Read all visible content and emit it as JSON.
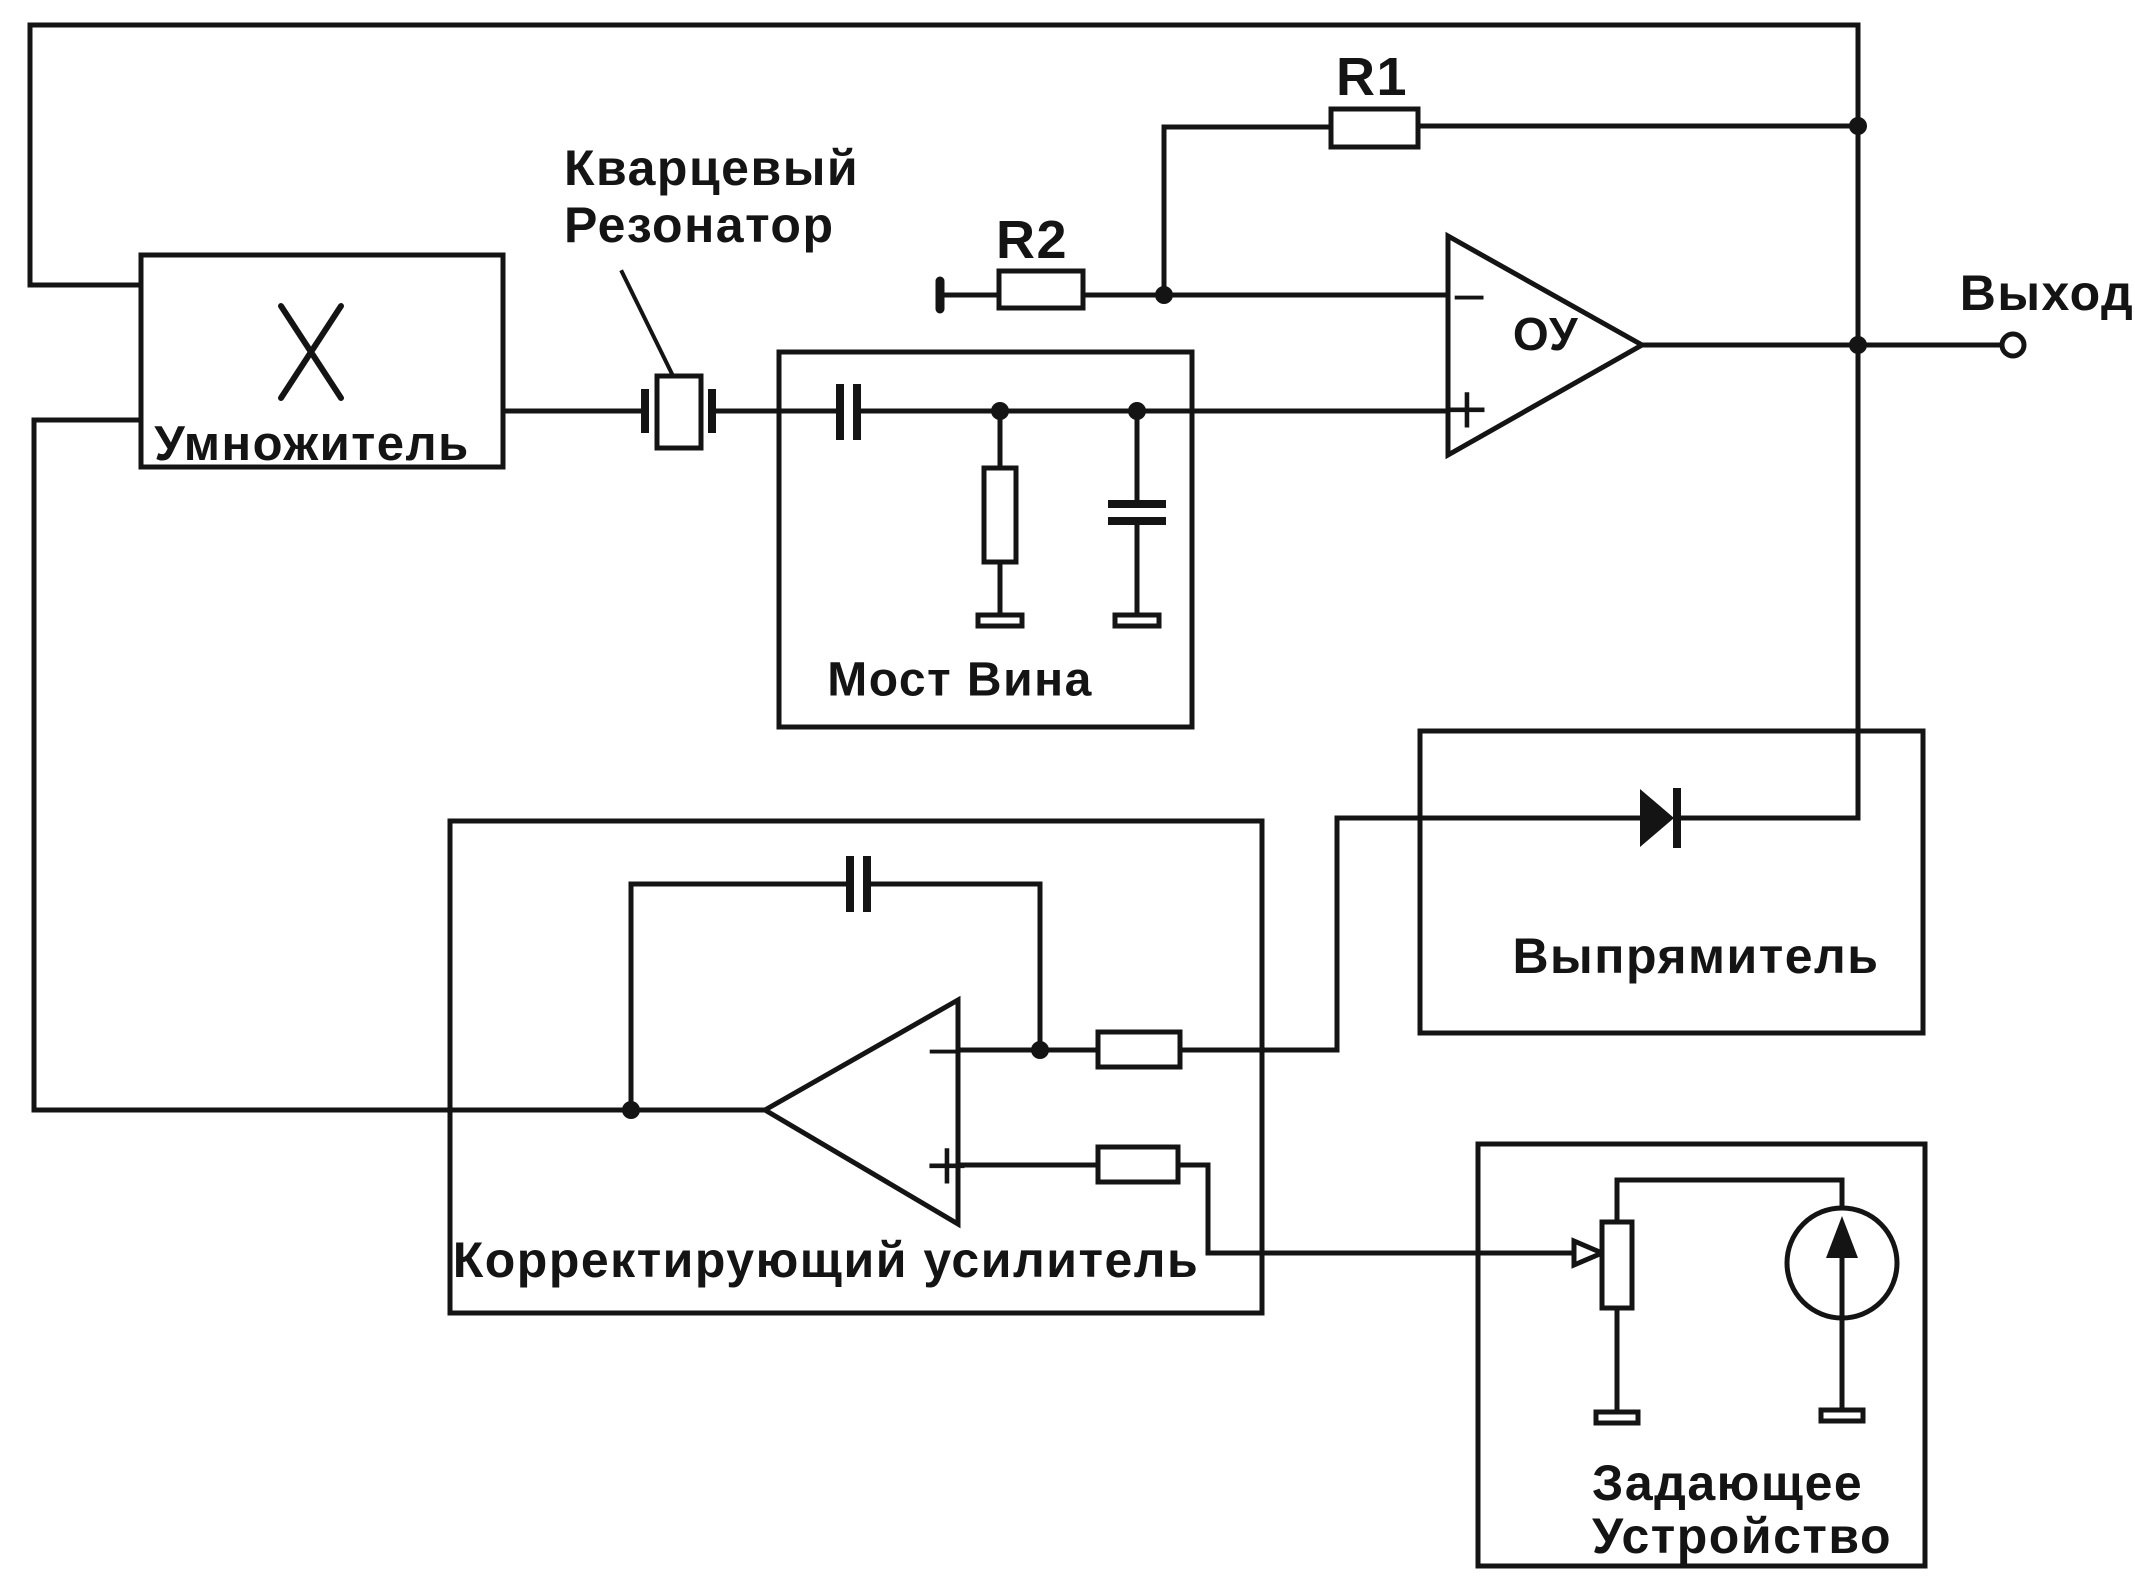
{
  "diagram": {
    "type": "circuit-block-diagram",
    "language": "ru",
    "paper_color": "#ffffff",
    "ink_color": "#141414",
    "blocks": {
      "multiplier": {
        "label": "Умножитель"
      },
      "wien_bridge": {
        "label": "Мост Вина"
      },
      "rectifier": {
        "label": "Выпрямитель"
      },
      "correcting_amplifier": {
        "label": "Корректирующий  усилитель"
      },
      "setting_device": {
        "label_line1": "Задающее",
        "label_line2": "Устройство"
      }
    },
    "callouts": {
      "quartz_resonator": {
        "line1": "Кварцевый",
        "line2": "Резонатор"
      }
    },
    "components": {
      "r1": {
        "label": "R1"
      },
      "r2": {
        "label": "R2"
      },
      "main_opamp": {
        "label": "ОУ",
        "minus": "−",
        "plus": "+"
      },
      "correcting_opamp": {
        "minus": "−",
        "plus": "+"
      },
      "output_terminal": {
        "label": "Выход"
      }
    }
  }
}
